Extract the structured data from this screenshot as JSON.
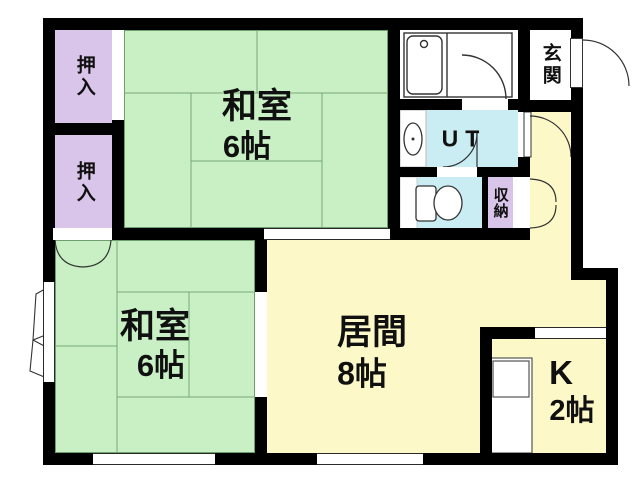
{
  "plan_type": "floorplan",
  "rooms": {
    "washitsu_top": {
      "name": "和室",
      "size": "6帖"
    },
    "washitsu_bottom": {
      "name": "和室",
      "size": "6帖"
    },
    "living": {
      "name": "居間",
      "size": "8帖"
    },
    "kitchen": {
      "name": "K",
      "size": "2帖"
    },
    "genkan": {
      "name": "玄関"
    },
    "utility": {
      "name": "UT"
    },
    "closet_upper": {
      "name": "押入"
    },
    "closet_lower": {
      "name": "押入"
    },
    "storage": {
      "name": "収納"
    }
  },
  "fixtures": {
    "bathtub": "bathtub",
    "washbasin": "washbasin",
    "toilet": "toilet",
    "kitchen_counter": "kitchen-sink-counter"
  },
  "colors": {
    "wall": "#000000",
    "tatami_green": "#c8f0c4",
    "closet_purple": "#d9c5e9",
    "wet_area_cyan": "#c9edf2",
    "floor_cream": "#fcf8c8",
    "line": "#333333",
    "tatami_line": "#77a877"
  }
}
